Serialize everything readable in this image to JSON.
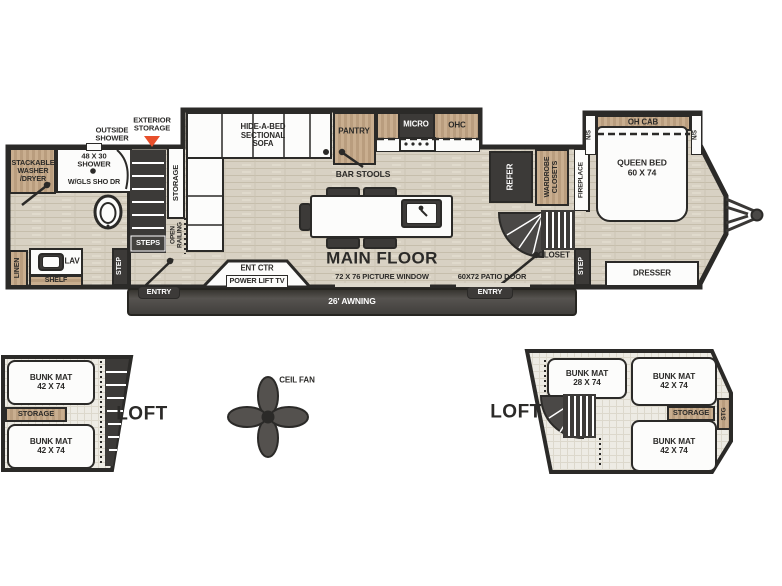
{
  "colors": {
    "accent_orange": "#e84f2b",
    "wall": "#2b2a28",
    "wood_tan": "#c9ae8f",
    "floor": "#d8d1c3",
    "fixture_dark": "#3c3a38"
  },
  "main_floor": {
    "callouts": {
      "outside_shower": "OUTSIDE\nSHOWER",
      "exterior_storage": "EXTERIOR\nSTORAGE"
    },
    "bath": {
      "washer": "STACKABLE\nWASHER\n/DRYER",
      "shower_size": "48 X 30\nSHOWER",
      "shower_door": "W/GLS SHO DR",
      "linen": "LINEN",
      "lav": "LAV",
      "shelf": "SHELF"
    },
    "stairs": {
      "storage": "STORAGE",
      "open_railing": "OPEN\nRAILING",
      "steps": "STEPS",
      "step": "STEP"
    },
    "living": {
      "sofa": "HIDE-A-BED\nSECTIONAL\nSOFA",
      "pantry": "PANTRY",
      "micro": "MICRO",
      "ohc": "OHC",
      "bar_stools": "BAR STOOLS",
      "title": "MAIN FLOOR",
      "picture_window": "72 X 76 PICTURE WINDOW",
      "ent_ctr": "ENT CTR",
      "power_lift_tv": "POWER LIFT TV",
      "awning": "26' AWNING",
      "entry_left": "ENTRY",
      "entry_right": "ENTRY",
      "patio_door": "60X72 PATIO DOOR",
      "refer": "REFER",
      "wardrobe": "WARDROBE\nCLOSETS",
      "fireplace": "FIREPLACE",
      "closet": "CLOSET",
      "step_right": "STEP"
    },
    "bedroom": {
      "oh_cab": "OH CAB",
      "ns_left": "N/S",
      "ns_right": "N/S",
      "queen_bed": "QUEEN BED\n60 X 74",
      "dresser": "DRESSER"
    }
  },
  "left_loft": {
    "bunk_top": "BUNK MAT\n42 X 74",
    "storage": "STORAGE",
    "bunk_bottom": "BUNK MAT\n42 X 74",
    "label": "LOFT"
  },
  "ceiling_fan": {
    "label": "CEIL FAN"
  },
  "right_loft": {
    "label": "LOFT",
    "bunk_left": "BUNK MAT\n28 X 74",
    "bunk_top": "BUNK MAT\n42 X 74",
    "storage": "STORAGE",
    "stg": "STG",
    "bunk_bottom": "BUNK MAT\n42 X 74"
  }
}
